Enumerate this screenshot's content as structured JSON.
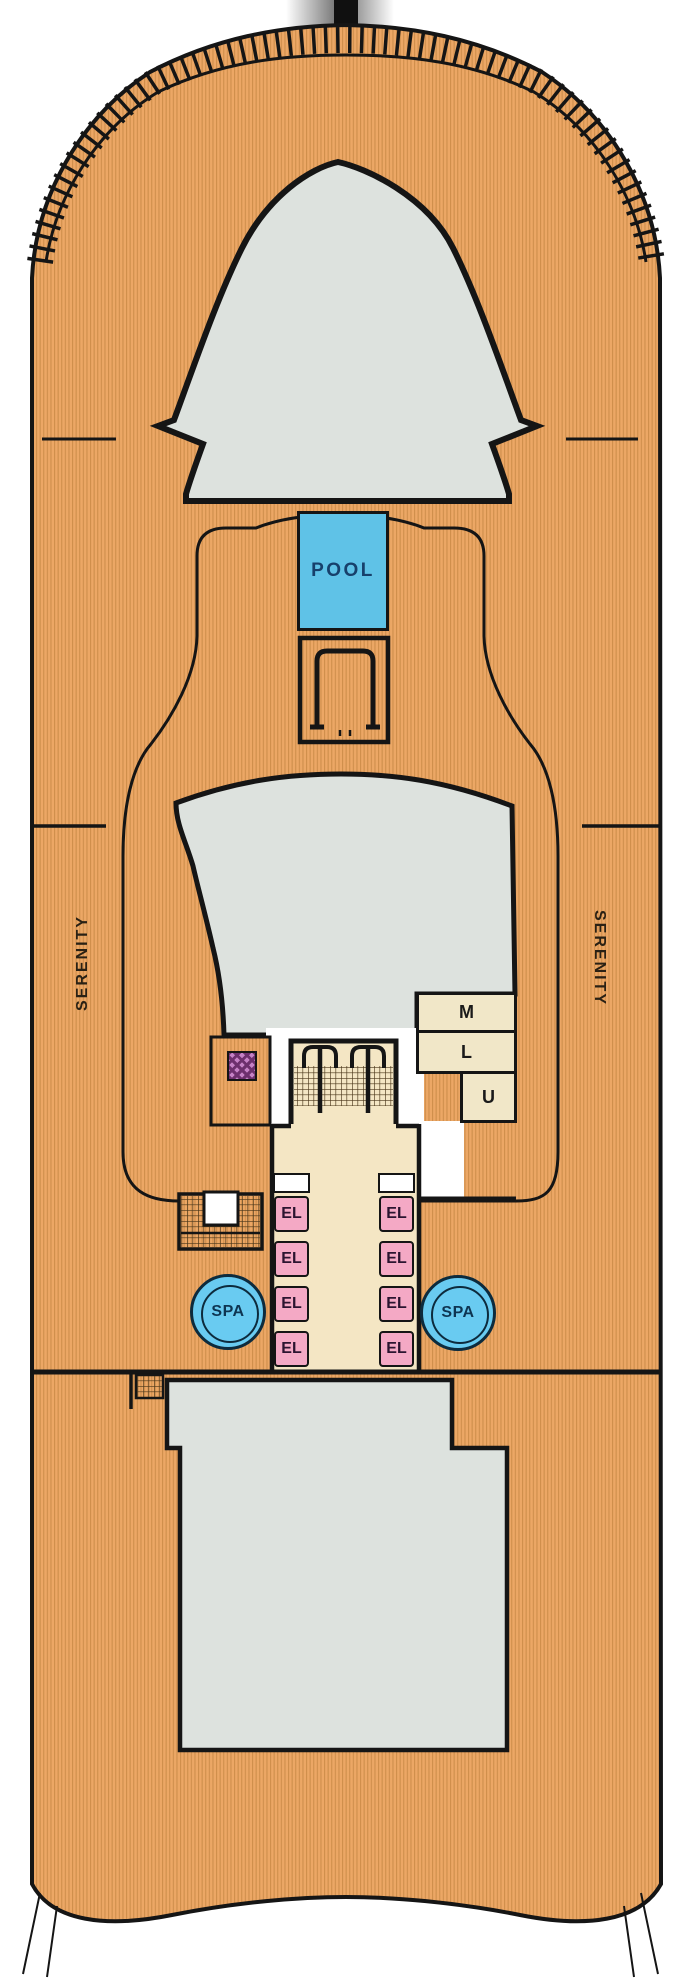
{
  "deck": {
    "side_label_port": "SERENITY",
    "side_label_starboard": "SERENITY",
    "pool_label": "POOL",
    "spa_label_left": "SPA",
    "spa_label_right": "SPA",
    "elevator_labels": [
      "EL",
      "EL",
      "EL",
      "EL",
      "EL",
      "EL",
      "EL",
      "EL"
    ],
    "landing_labels": {
      "m": "M",
      "l": "L",
      "u": "U"
    },
    "colors": {
      "deck_wood": "#ECA765",
      "deck_stripe": "#CE8E4B",
      "structure_gray": "#DDE2DE",
      "pool_blue": "#5FC2E7",
      "spa_blue": "#69CBF1",
      "elevator_pink": "#F4A9C5",
      "landing_cream": "#F1E7C8",
      "stair_beige": "#F4E6C4",
      "facility_purple": "#C581C5",
      "outline": "#151515"
    }
  }
}
